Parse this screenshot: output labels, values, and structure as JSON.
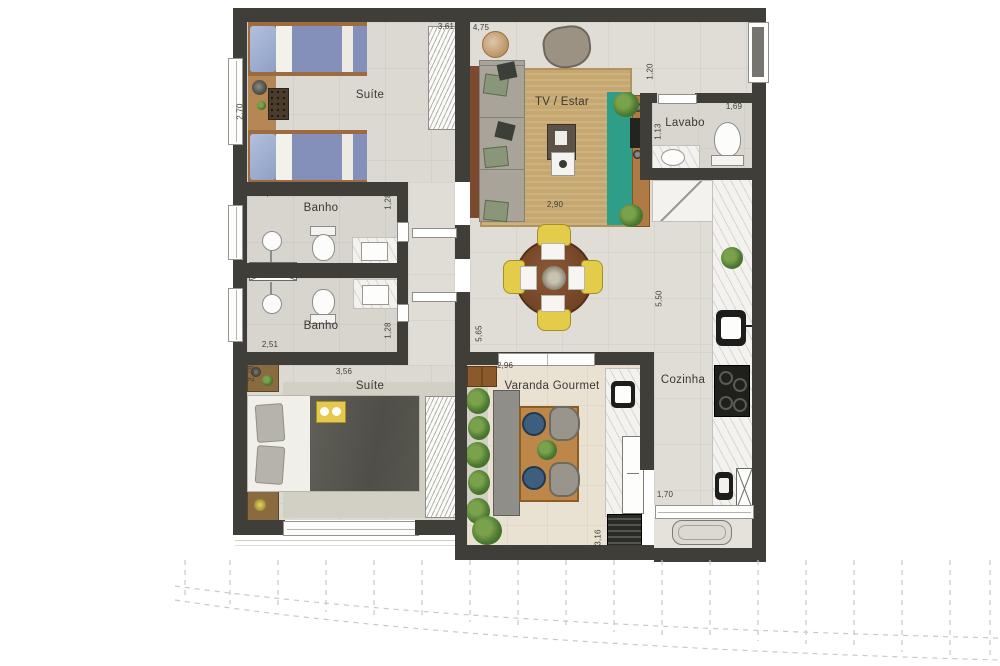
{
  "title": "Apartment floor plan",
  "rooms": {
    "suite1": "Suíte",
    "banho1": "Banho",
    "banho2": "Banho",
    "tv_estar": "TV / Estar",
    "lavabo": "Lavabo",
    "cozinha": "Cozinha",
    "suite2": "Suíte",
    "varanda": "Varanda Gourmet"
  },
  "dims": {
    "suite1_w": "3,61",
    "suite1_d": "2,70",
    "banho1_w": "2,51",
    "banho1_d": "1,28",
    "banho2_w": "2,51",
    "banho2_d": "1,28",
    "living_w": "4,75",
    "entry_d": "1,20",
    "rug_w": "2,90",
    "lavabo_w": "1,69",
    "lavabo_d": "1,13",
    "dining_d": "5,50",
    "hall_d": "5,65",
    "suite2_w": "3,56",
    "suite2_d": "2,78",
    "varanda_w": "2,96",
    "varanda_d": "3,16",
    "service_w": "1,70"
  },
  "colors": {
    "wall": "#3f3e39",
    "floor": "#dfddd5",
    "varanda_floor": "#e9e2d2",
    "living_rug": "#c5a76f",
    "media_runner_teal": "#2f9e88",
    "wood": "#b07a45",
    "bed_blue": "#8590ba",
    "blanket_dark": "#57564f",
    "marble": "#f3f2ee",
    "chair_yellow": "#e3cc4a",
    "plant_green": "#4c7a31"
  }
}
